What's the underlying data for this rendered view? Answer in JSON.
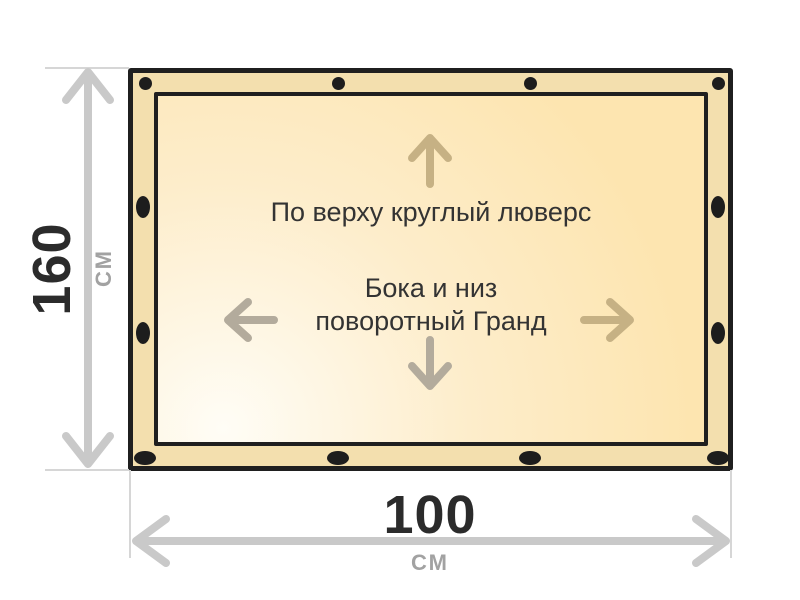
{
  "banner": {
    "top_note": "По верху круглый люверс",
    "center_note_line1": "Бока и низ",
    "center_note_line2": "поворотный Гранд",
    "grommets": {
      "top_count": 4,
      "bottom_count": 4,
      "left_count": 2,
      "right_count": 2
    }
  },
  "dimensions": {
    "height": {
      "value": "160",
      "unit": "СМ"
    },
    "width": {
      "value": "100",
      "unit": "СМ"
    }
  },
  "colors": {
    "ink": "#1f1f1f",
    "band": "#f3dfae",
    "fill-light": "#fffdf6",
    "fill-mid": "#fdedcb",
    "fill-deep": "#fde5b0",
    "arrow-tan": "#c6b184",
    "arrow-gray": "#b3ab9c",
    "dim-gray": "#c9c9c9",
    "ext-gray": "#d6d6d6",
    "text-dark": "#333333",
    "num-dark": "#2b2b2b",
    "unit-gray": "#a2a2a2",
    "grommet": "#1d1d1d",
    "page-bg": "#ffffff"
  }
}
